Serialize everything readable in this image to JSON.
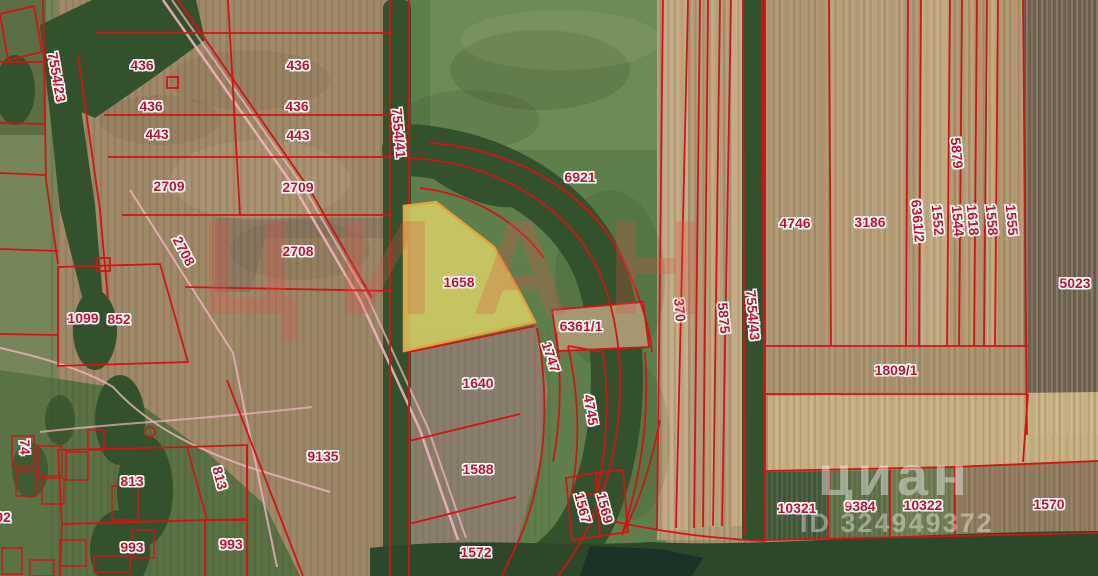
{
  "colors": {
    "boundary_red": "#d21414",
    "road_pink": "#f2b3bf",
    "highlight_fill": "#ded468",
    "highlight_stroke": "#e2a43c",
    "label_red": "#c8102e"
  },
  "watermarks": {
    "center_logo": "ЦИАН",
    "corner_logo": "циан",
    "corner_id": "ID 324949372"
  },
  "parcels": {
    "highlighted": "1658",
    "labels": [
      {
        "n": "7554/23",
        "x": 57,
        "y": 77,
        "r": 80
      },
      {
        "n": "436",
        "x": 142,
        "y": 65,
        "r": 0
      },
      {
        "n": "436",
        "x": 298,
        "y": 65,
        "r": 0
      },
      {
        "n": "436",
        "x": 151,
        "y": 106,
        "r": 0
      },
      {
        "n": "436",
        "x": 297,
        "y": 106,
        "r": 0
      },
      {
        "n": "443",
        "x": 157,
        "y": 134,
        "r": 0
      },
      {
        "n": "443",
        "x": 298,
        "y": 135,
        "r": 0
      },
      {
        "n": "2709",
        "x": 169,
        "y": 186,
        "r": 0
      },
      {
        "n": "2709",
        "x": 298,
        "y": 187,
        "r": 0
      },
      {
        "n": "2708",
        "x": 184,
        "y": 251,
        "r": 62
      },
      {
        "n": "2708",
        "x": 298,
        "y": 251,
        "r": 0
      },
      {
        "n": "1099",
        "x": 83,
        "y": 318,
        "r": 0
      },
      {
        "n": "852",
        "x": 119,
        "y": 319,
        "r": 0
      },
      {
        "n": "9135",
        "x": 323,
        "y": 456,
        "r": 0
      },
      {
        "n": "813",
        "x": 132,
        "y": 481,
        "r": 0
      },
      {
        "n": "813",
        "x": 220,
        "y": 478,
        "r": 75
      },
      {
        "n": "993",
        "x": 132,
        "y": 547,
        "r": 0
      },
      {
        "n": "993",
        "x": 231,
        "y": 544,
        "r": 0
      },
      {
        "n": "74",
        "x": 25,
        "y": 447,
        "r": 88
      },
      {
        "n": "92",
        "x": 3,
        "y": 517,
        "r": 0
      },
      {
        "n": "7554/41",
        "x": 399,
        "y": 133,
        "r": 85
      },
      {
        "n": "6921",
        "x": 580,
        "y": 177,
        "r": 0
      },
      {
        "n": "1658",
        "x": 459,
        "y": 282,
        "r": 0,
        "h": true
      },
      {
        "n": "6361/1",
        "x": 581,
        "y": 326,
        "r": 0
      },
      {
        "n": "1747",
        "x": 551,
        "y": 357,
        "r": 72
      },
      {
        "n": "1640",
        "x": 478,
        "y": 383,
        "r": 0
      },
      {
        "n": "4745",
        "x": 591,
        "y": 410,
        "r": 80
      },
      {
        "n": "1588",
        "x": 478,
        "y": 469,
        "r": 0
      },
      {
        "n": "1572",
        "x": 476,
        "y": 552,
        "r": 0
      },
      {
        "n": "1567",
        "x": 583,
        "y": 508,
        "r": 75
      },
      {
        "n": "1569",
        "x": 605,
        "y": 508,
        "r": 75
      },
      {
        "n": "370",
        "x": 680,
        "y": 310,
        "r": 85
      },
      {
        "n": "5875",
        "x": 724,
        "y": 318,
        "r": 85
      },
      {
        "n": "7554/43",
        "x": 753,
        "y": 315,
        "r": 85
      },
      {
        "n": "4746",
        "x": 795,
        "y": 223,
        "r": 0
      },
      {
        "n": "3186",
        "x": 870,
        "y": 222,
        "r": 0
      },
      {
        "n": "6361/2",
        "x": 918,
        "y": 221,
        "r": 85
      },
      {
        "n": "1552",
        "x": 938,
        "y": 220,
        "r": 85
      },
      {
        "n": "5879",
        "x": 957,
        "y": 153,
        "r": 85
      },
      {
        "n": "1544",
        "x": 958,
        "y": 221,
        "r": 85
      },
      {
        "n": "1618",
        "x": 973,
        "y": 220,
        "r": 85
      },
      {
        "n": "1558",
        "x": 992,
        "y": 220,
        "r": 85
      },
      {
        "n": "1555",
        "x": 1012,
        "y": 220,
        "r": 85
      },
      {
        "n": "5023",
        "x": 1075,
        "y": 283,
        "r": 0
      },
      {
        "n": "1809/1",
        "x": 896,
        "y": 370,
        "r": 0
      },
      {
        "n": "10321",
        "x": 797,
        "y": 508,
        "r": 0
      },
      {
        "n": "9384",
        "x": 860,
        "y": 506,
        "r": 0
      },
      {
        "n": "10322",
        "x": 923,
        "y": 505,
        "r": 0
      },
      {
        "n": "1570",
        "x": 1049,
        "y": 504,
        "r": 0
      }
    ]
  }
}
